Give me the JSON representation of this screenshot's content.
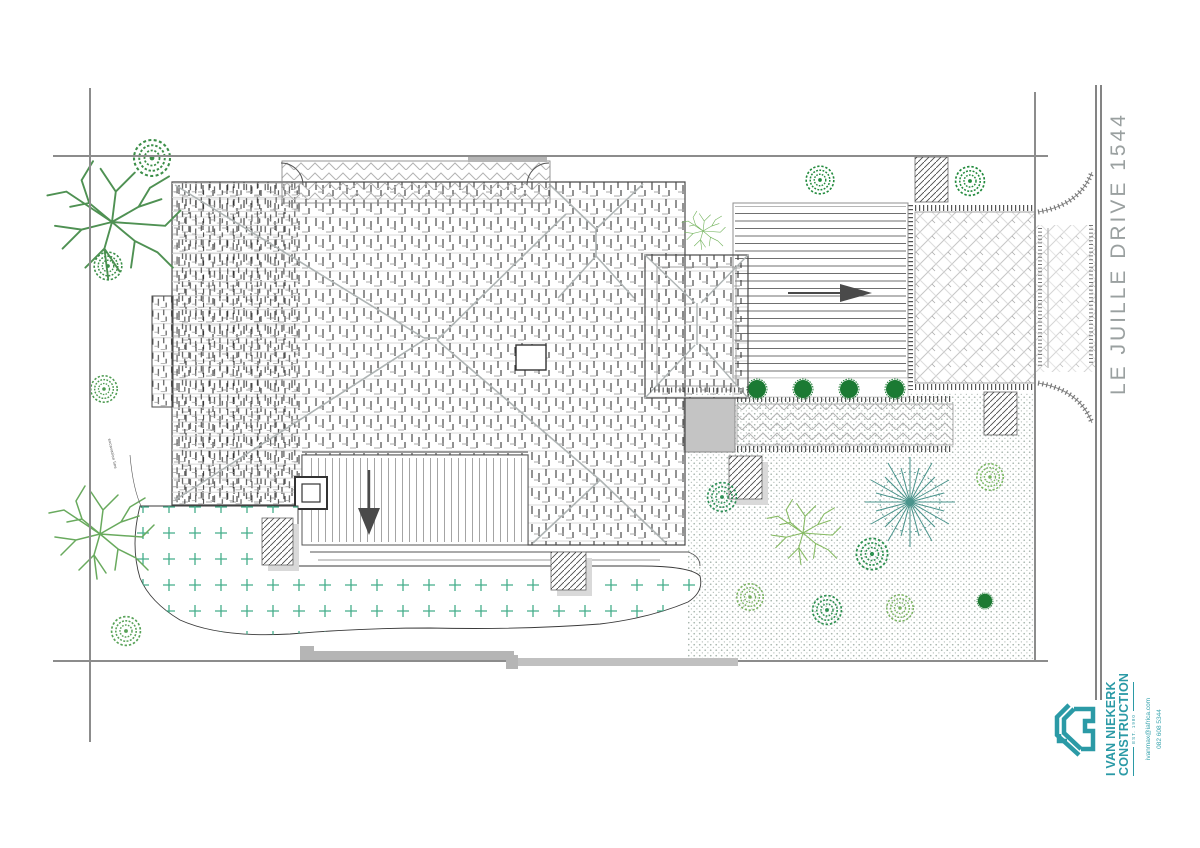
{
  "street": {
    "label": "LE JUILLE DRIVE 1544"
  },
  "logo": {
    "name_line1": "I VAN NIEKERK",
    "name_line2": "CONSTRUCTION",
    "tagline": "EST. 1980",
    "email": "ivanmax@iafrica.com",
    "phone": "082 608 5344",
    "brand_color": "#2b9aa6"
  },
  "annotation": {
    "text": "excavation line"
  },
  "drawing": {
    "type": "site / roof plan",
    "arrows": [
      {
        "direction": "right",
        "location": "driveway-ramp"
      },
      {
        "direction": "down",
        "location": "rear-deck"
      }
    ],
    "palette": {
      "boundary_gray": "#8c8c8c",
      "roof_line_dark": "#383838",
      "roof_line_light": "#d8d8d8",
      "paving_gray": "#c0c0c0",
      "lawn_plus_green": "#44ad8a",
      "garden_dot_gray": "#a8b6ae",
      "tree_green_dark": "#218a3c",
      "tree_green_light": "#86bb62",
      "tree_teal": "#4a948c",
      "arrow_gray": "#4a4a4a",
      "street_text_gray": "#9aa0a0"
    }
  }
}
